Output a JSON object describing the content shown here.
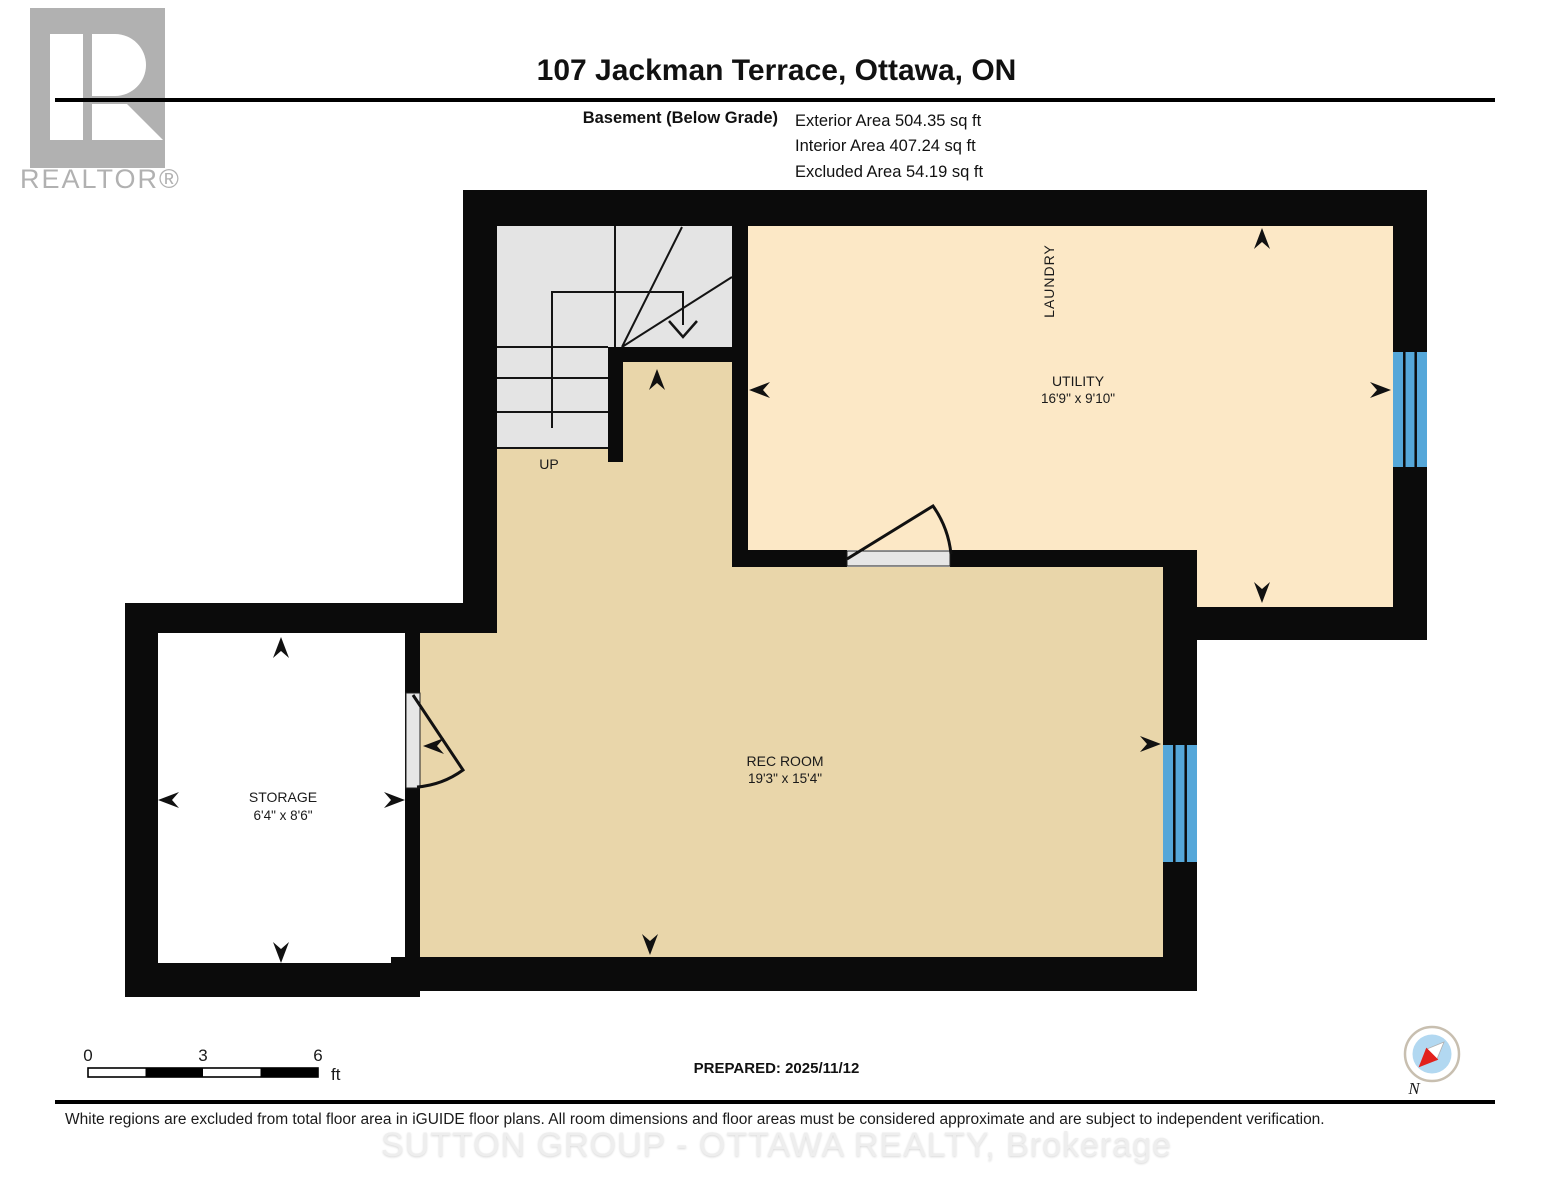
{
  "header": {
    "title": "107 Jackman Terrace, Ottawa, ON",
    "floor_label": "Basement (Below Grade)",
    "exterior_area": "Exterior Area 504.35 sq ft",
    "interior_area": "Interior Area 407.24 sq ft",
    "excluded_area": "Excluded Area 54.19 sq ft"
  },
  "logo": {
    "brand": "REALTOR®"
  },
  "plan": {
    "rooms": {
      "laundry": {
        "name": "LAUNDRY"
      },
      "utility": {
        "name": "UTILITY",
        "dims": "16'9\" x 9'10\""
      },
      "rec": {
        "name": "REC ROOM",
        "dims": "19'3\" x 15'4\""
      },
      "storage": {
        "name": "STORAGE",
        "dims": "6'4\" x 8'6\""
      }
    },
    "stairs": {
      "label": "UP"
    }
  },
  "scale_bar": {
    "tick0": "0",
    "tick1": "3",
    "tick2": "6",
    "unit": "ft"
  },
  "footer": {
    "prepared": "PREPARED: 2025/11/12",
    "compass_label": "N",
    "disclaimer": "White regions are excluded from total floor area in iGUIDE floor plans. All room dimensions and floor areas must be considered approximate and are subject to independent verification.",
    "watermark": "SUTTON GROUP - OTTAWA REALTY, Brokerage"
  },
  "colors": {
    "wall": "#0b0b0b",
    "utility_floor": "#fce8c6",
    "rec_floor": "#e9d6aa",
    "stair_floor": "#e4e4e4",
    "door": "#e6e6e6",
    "window": "#55a7d9",
    "excluded_floor": "#ffffff",
    "logo_gray": "#b1b1b1",
    "compass_red": "#e2211c",
    "compass_blue": "#b2d8f1",
    "compass_ring": "#c8bfb0"
  }
}
